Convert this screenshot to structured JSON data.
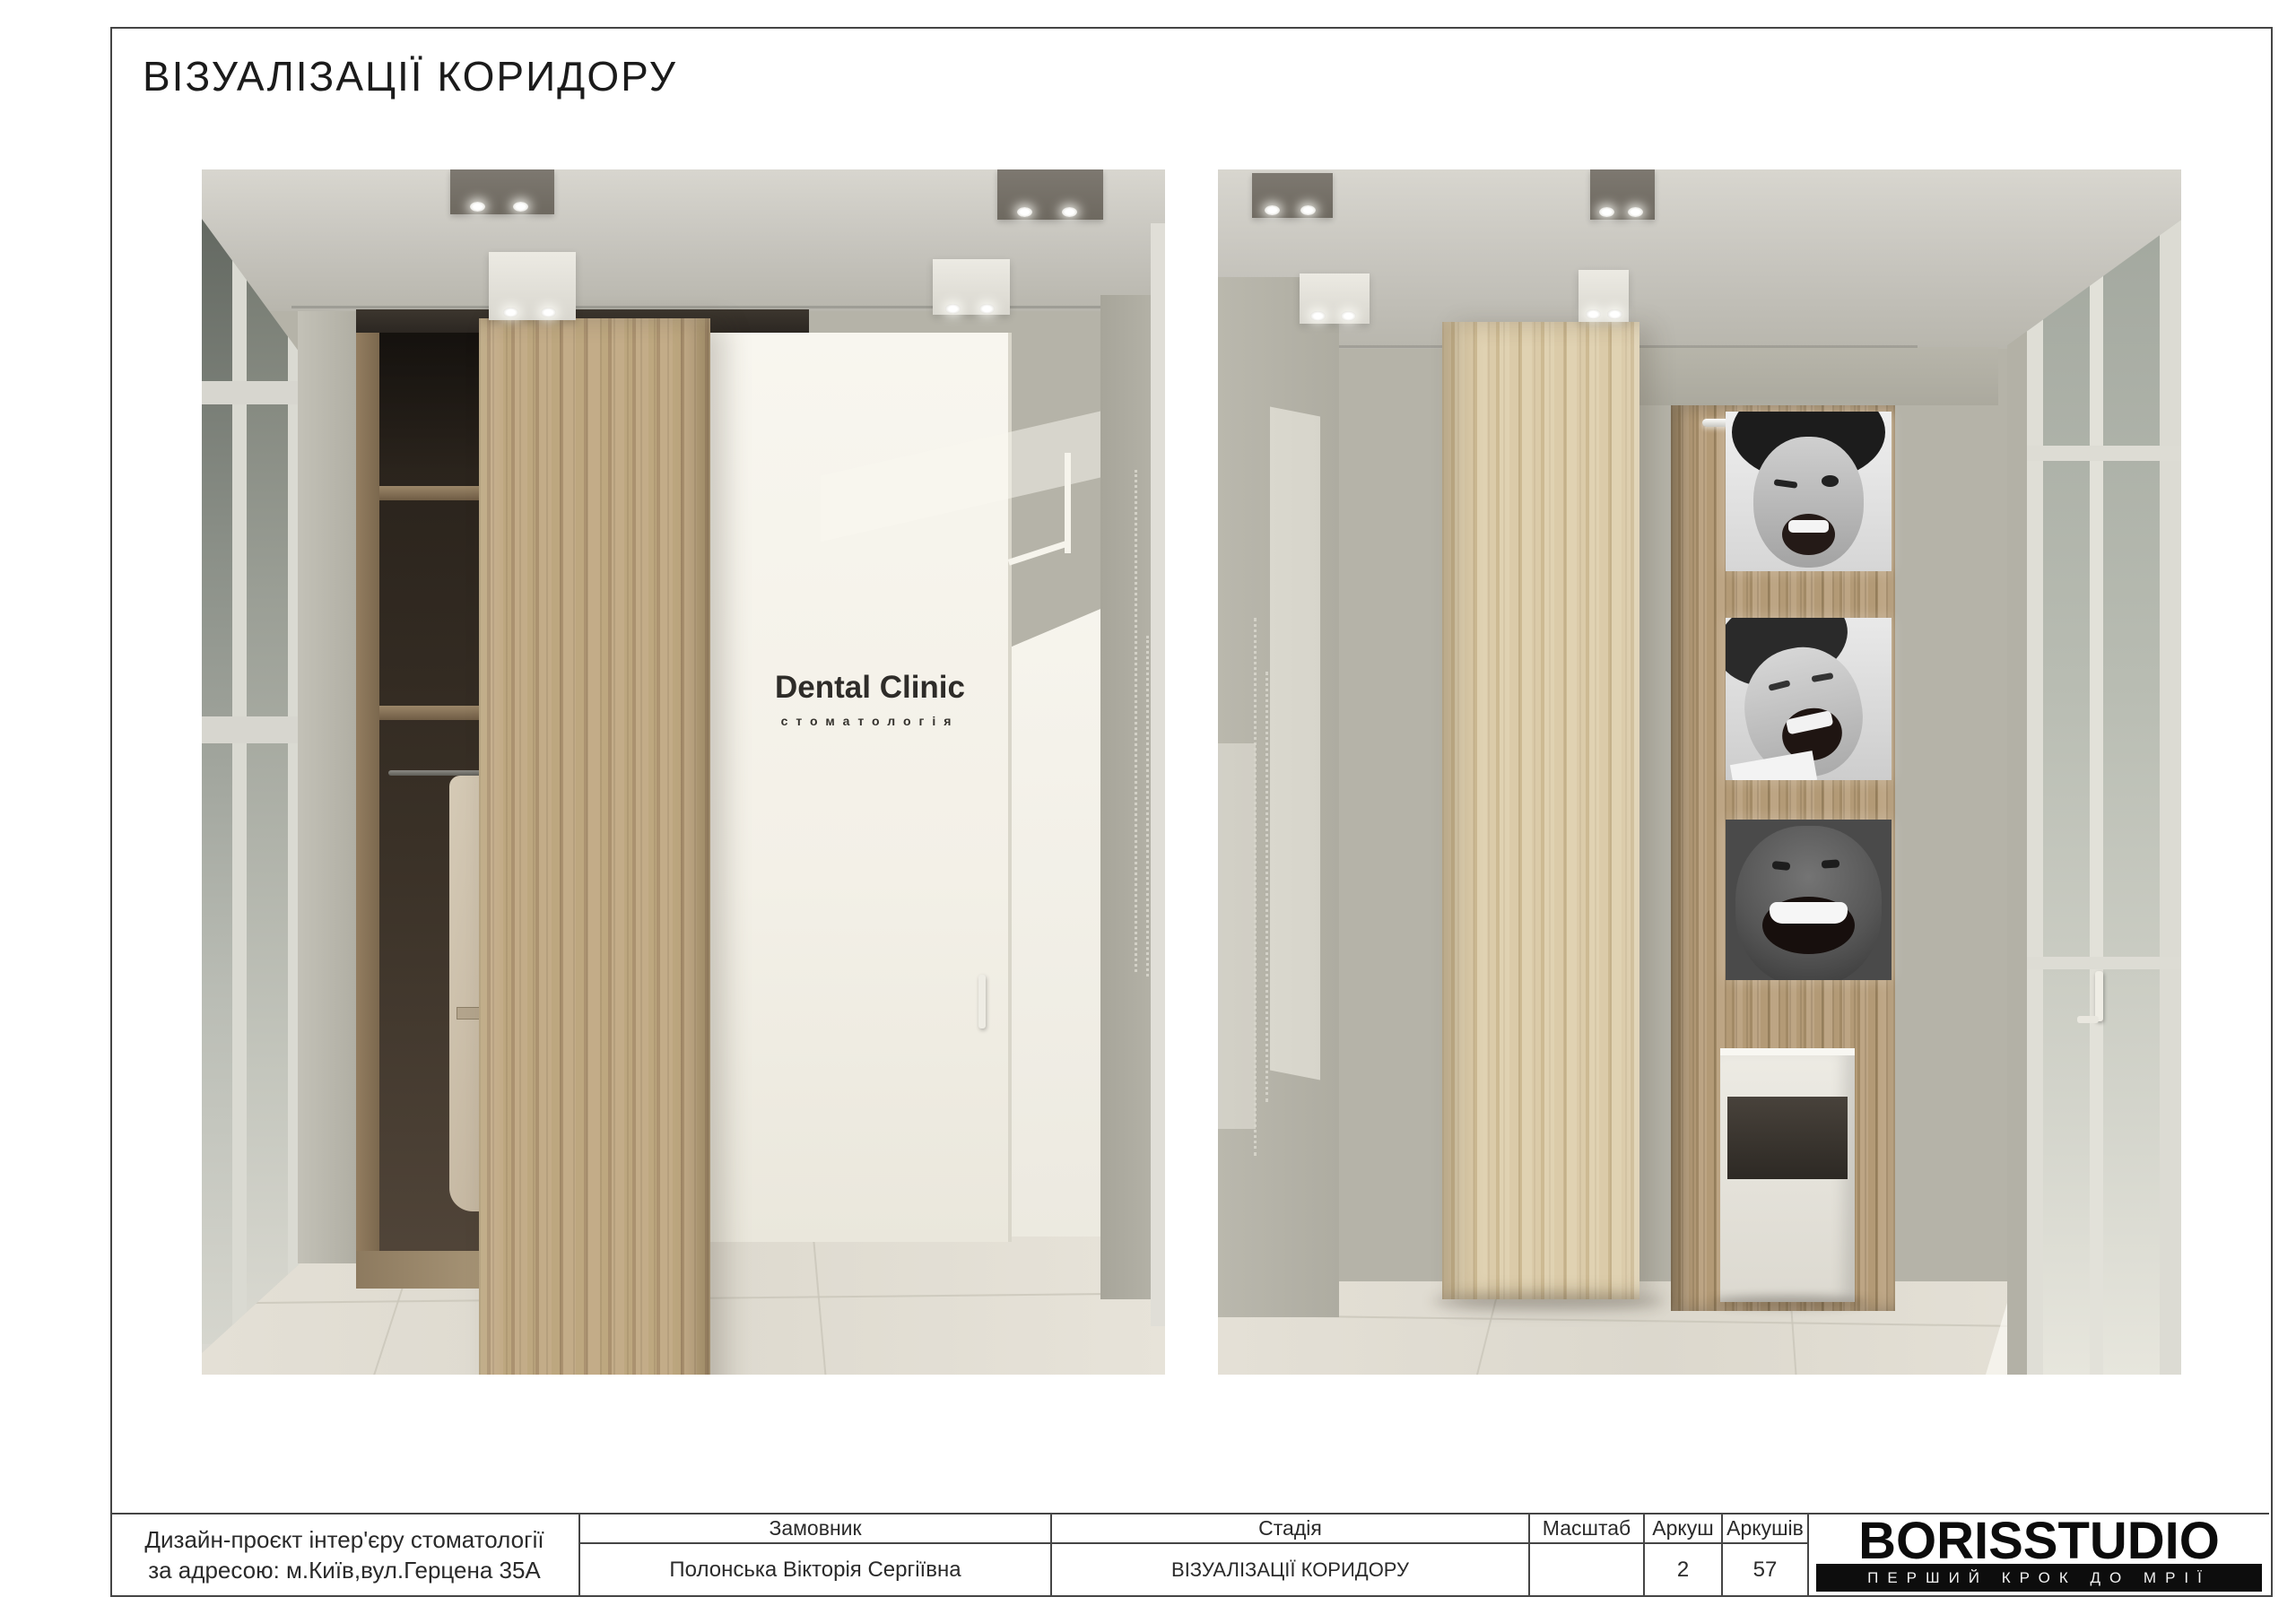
{
  "page": {
    "title": "ВІЗУАЛІЗАЦІЇ КОРИДОРУ"
  },
  "left_render": {
    "door_sign": {
      "title": "Dental Clinic",
      "subtitle": "стоматологія"
    }
  },
  "title_block": {
    "project_description": {
      "line1": "Дизайн-проєкт інтер'єру стоматології",
      "line2": "за адресою: м.Київ,вул.Герцена 35А"
    },
    "client": {
      "label": "Замовник",
      "value": "Полонська Вікторія Сергіївна"
    },
    "stage": {
      "label": "Стадія",
      "value": "ВІЗУАЛІЗАЦІЇ КОРИДОРУ"
    },
    "scale": {
      "label": "Масштаб",
      "value": ""
    },
    "sheet": {
      "label": "Аркуш",
      "value": "2"
    },
    "sheets_total": {
      "label": "Аркушів",
      "value": "57"
    },
    "logo": {
      "name": "BORISSTUDIO",
      "tagline": "ПЕРШИЙ КРОК ДО МРІЇ"
    }
  },
  "colors": {
    "sheet_line": "#454545",
    "wall": "#b5b3a8",
    "ceiling": "#d3d1ca",
    "wood_light": "#d5c4a3",
    "wood_medium": "#b49e7f",
    "wood_dark": "#a28a66",
    "floor": "#e2ded4",
    "sunlight": "#f8f6ee",
    "logo_bg": "#0d0d0d"
  }
}
